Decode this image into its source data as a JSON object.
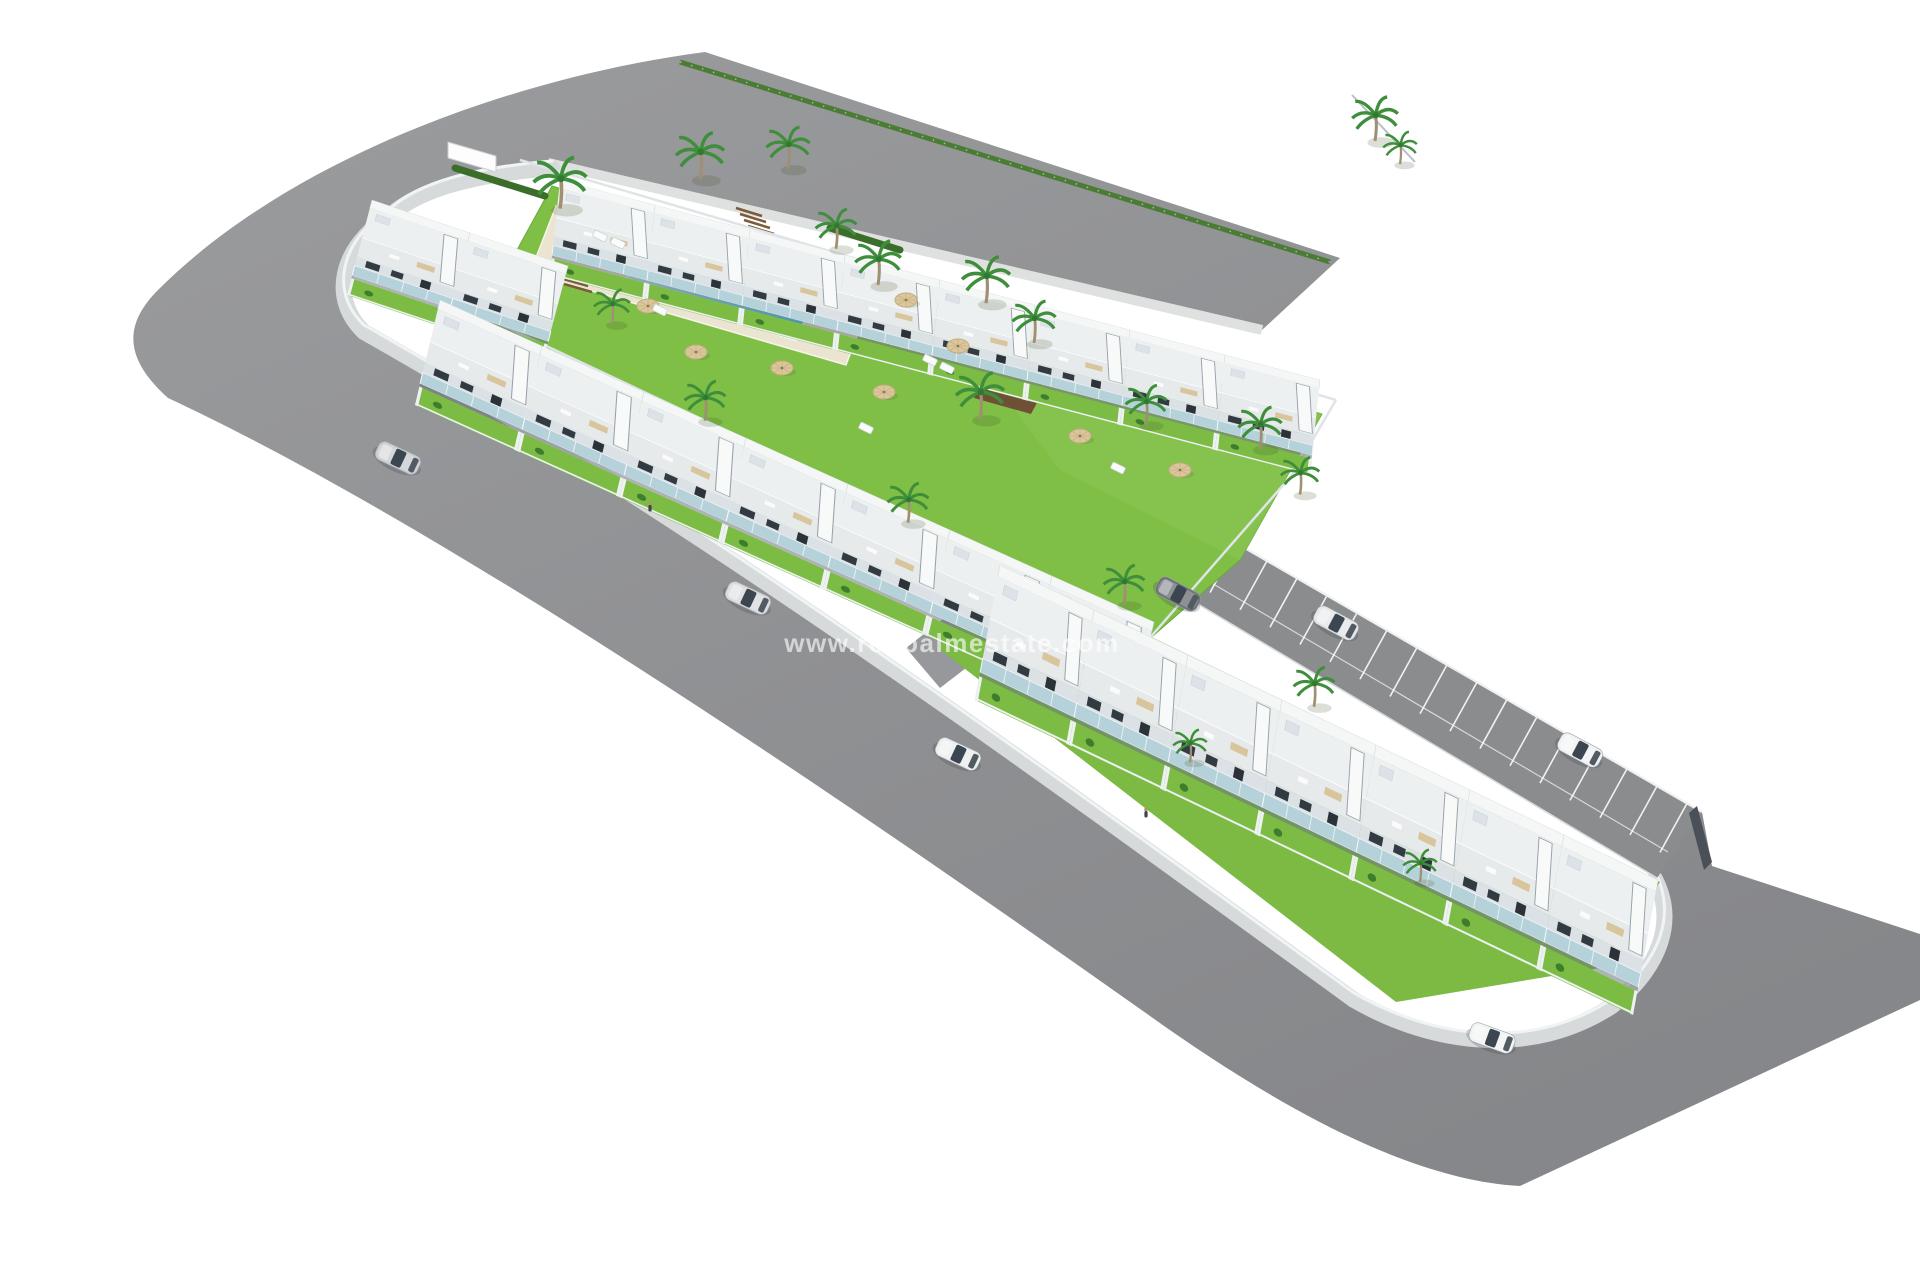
{
  "meta": {
    "kind": "3d-aerial-architectural-render",
    "subject": "residential development with townhouse rows, central pool garden, parking strip and L-shaped perimeter roads"
  },
  "watermark": {
    "text": "www.redpalmestate.com",
    "x": 952,
    "y": 652,
    "font_size": 26,
    "letter_spacing": 1.5,
    "color": "#ffffff",
    "opacity": 0.62
  },
  "palette": {
    "background": "#ffffff",
    "road_light": "#9b9c9e",
    "road_dark": "#86878a",
    "parking_asphalt": "#8a8c8e",
    "sidewalk": "#d7dadb",
    "curb_white": "#f1f4f5",
    "lawn": "#7fbf46",
    "lawn_light": "#8ac653",
    "hedge": "#4b7c33",
    "pool_deep": "#2eb6e2",
    "pool_light": "#bfeef8",
    "kids_pool": "#6fd4ef",
    "deck": "#eae4d1",
    "house_white": "#f5f7f6",
    "roof": "#edf0f0",
    "terrace": "#e6eaeb",
    "facade_shade": "#dbe1e5",
    "window_dark": "#323a42",
    "balcony_glass": "#b5d1d9",
    "wall_gray": "#dfe4e8",
    "steps_brown": "#7b5b3b",
    "pergola_brown": "#6f5036",
    "parasol_tan": "#dbc79d",
    "car_glass": "#3c4651",
    "dark_wall": "#4a5058"
  },
  "road": {
    "outline": "M1340,258 L705,52 C520,76 292,156 158,290 C120,328 128,362 168,398 C430,520 810,775 1150,1016 C1275,1105 1408,1180 1520,1186 L1920,1000 L1920,934 L1712,866 L1702,812 L1042,431 L1005,489 L1657,878 C1678,922 1662,968 1610,1008 C1530,1062 1430,1048 1352,1000 C1052,780 700,522 364,332 C330,300 338,248 392,214 C420,190 470,175 552,168 L1262,330 Z",
    "sidewalk": "M552,168 C470,175 420,190 392,214 C338,248 330,300 364,332 C700,522 1052,780 1354,1000 C1434,1046 1532,1058 1612,1006 C1662,966 1676,920 1655,879",
    "verge": [
      548,
      163,
      1262,
      330
    ],
    "hedge": [
      680,
      62,
      1330,
      262
    ],
    "fence_ne": [
      1352,
      95,
      1415,
      162
    ]
  },
  "parking": {
    "surface": [
      [
        1042,
        431
      ],
      [
        1702,
        812
      ],
      [
        1657,
        878
      ],
      [
        1005,
        489
      ]
    ],
    "ne_edge": [
      1042,
      431,
      1702,
      812
    ],
    "sw_edge": [
      1005,
      489,
      1657,
      878
    ],
    "lane_line": [
      1020,
      470,
      1668,
      852
    ],
    "bays": 22,
    "bay_vector": [
      -27,
      49
    ],
    "line_color": "#f0f1f2",
    "end_wall": [
      [
        1697,
        806
      ],
      [
        1712,
        862
      ],
      [
        1704,
        870
      ],
      [
        1689,
        813
      ]
    ],
    "driveway": [
      [
        906,
        648
      ],
      [
        952,
        612
      ],
      [
        992,
        648
      ],
      [
        940,
        688
      ]
    ]
  },
  "lawns": {
    "main": [
      [
        552,
        186
      ],
      [
        1322,
        414
      ],
      [
        1240,
        560
      ],
      [
        1146,
        642
      ],
      [
        470,
        336
      ]
    ],
    "light_overlay": [
      [
        940,
        310
      ],
      [
        1322,
        414
      ],
      [
        1240,
        560
      ],
      [
        1060,
        470
      ]
    ],
    "row_c_base": [
      [
        1002,
        565
      ],
      [
        1660,
        882
      ],
      [
        1600,
        968
      ],
      [
        1396,
        1002
      ],
      [
        938,
        648
      ]
    ]
  },
  "pool": {
    "deck": [
      [
        556,
        206
      ],
      [
        872,
        297
      ],
      [
        846,
        365
      ],
      [
        530,
        273
      ]
    ],
    "water": [
      [
        640,
        250
      ],
      [
        814,
        300
      ],
      [
        796,
        340
      ],
      [
        622,
        288
      ]
    ],
    "kids": [
      [
        585,
        222
      ],
      [
        634,
        236
      ],
      [
        626,
        252
      ],
      [
        577,
        238
      ]
    ],
    "steps": [
      [
        736,
        208,
        762,
        216
      ],
      [
        740,
        214,
        766,
        222
      ],
      [
        744,
        220,
        770,
        228
      ],
      [
        748,
        226,
        774,
        234
      ],
      [
        556,
        272,
        584,
        280
      ],
      [
        560,
        278,
        588,
        286
      ],
      [
        564,
        284,
        592,
        292
      ]
    ],
    "pergola": [
      [
        983,
        381
      ],
      [
        1040,
        397
      ],
      [
        1031,
        414
      ],
      [
        974,
        398
      ]
    ]
  },
  "rows": [
    {
      "name": "top-row",
      "origin": [
        560,
        180
      ],
      "spacing": [
        95,
        25
      ],
      "depth": [
        -10,
        95
      ],
      "count": 8
    },
    {
      "name": "west-corner-row",
      "origin": [
        372,
        200
      ],
      "spacing": [
        98,
        33
      ],
      "depth": [
        -25,
        95
      ],
      "count": 2
    },
    {
      "name": "south-row-upper-block",
      "origin": [
        440,
        300
      ],
      "spacing": [
        102,
        46
      ],
      "depth": [
        -25,
        105
      ],
      "count": 7
    },
    {
      "name": "lower-row",
      "origin": [
        1000,
        565
      ],
      "spacing": [
        94,
        45
      ],
      "depth": [
        -25,
        135
      ],
      "count": 7
    }
  ],
  "walls": [
    [
      520,
      160,
      1336,
      400
    ],
    [
      1336,
      400,
      1292,
      475
    ],
    [
      1292,
      475,
      1148,
      640
    ],
    [
      440,
      296,
      1146,
      628
    ]
  ],
  "palms": [
    [
      560,
      205,
      1.1
    ],
    [
      700,
      176,
      1
    ],
    [
      788,
      166,
      0.9
    ],
    [
      836,
      246,
      0.85
    ],
    [
      878,
      282,
      0.95
    ],
    [
      986,
      300,
      1
    ],
    [
      1034,
      340,
      0.9
    ],
    [
      980,
      416,
      1
    ],
    [
      1146,
      422,
      0.85
    ],
    [
      1260,
      446,
      0.9
    ],
    [
      1300,
      492,
      0.8
    ],
    [
      705,
      418,
      0.85
    ],
    [
      908,
      520,
      0.85
    ],
    [
      1124,
      602,
      0.85
    ],
    [
      1314,
      704,
      0.85
    ],
    [
      612,
      322,
      0.75
    ],
    [
      1375,
      138,
      0.95
    ],
    [
      1400,
      162,
      0.7
    ],
    [
      1190,
      760,
      0.7
    ],
    [
      1420,
      880,
      0.7
    ]
  ],
  "parasols": [
    [
      648,
      306
    ],
    [
      696,
      352
    ],
    [
      782,
      368
    ],
    [
      884,
      392
    ],
    [
      958,
      346
    ],
    [
      906,
      300
    ],
    [
      1080,
      436
    ],
    [
      1180,
      470
    ]
  ],
  "loungers": [
    [
      600,
      236
    ],
    [
      618,
      243
    ],
    [
      930,
      360
    ],
    [
      947,
      368
    ],
    [
      866,
      428
    ],
    [
      1118,
      468
    ],
    [
      660,
      310
    ]
  ],
  "hedgerows": [
    [
      455,
      168,
      545,
      196
    ],
    [
      830,
      228,
      900,
      250
    ]
  ],
  "utility_box": [
    [
      448,
      142
    ],
    [
      496,
      156
    ],
    [
      496,
      172
    ],
    [
      448,
      158
    ]
  ],
  "figures": [
    [
      650,
      508
    ],
    [
      1146,
      814
    ]
  ],
  "cars": [
    {
      "x": 398,
      "y": 458,
      "angle": 25,
      "color": "#c9cdd1",
      "state": "driving"
    },
    {
      "x": 748,
      "y": 598,
      "angle": 25,
      "color": "#d8dadc",
      "state": "driving"
    },
    {
      "x": 958,
      "y": 754,
      "angle": 25,
      "color": "#ebedee",
      "state": "driving"
    },
    {
      "x": 1336,
      "y": 623,
      "angle": 28,
      "color": "#e4e6e8",
      "state": "driving"
    },
    {
      "x": 1178,
      "y": 594,
      "angle": 28,
      "color": "#6d7277",
      "state": "parked"
    },
    {
      "x": 1580,
      "y": 750,
      "angle": 28,
      "color": "#f0f1f2",
      "state": "parked"
    },
    {
      "x": 1492,
      "y": 1038,
      "angle": 20,
      "color": "#f1f2f3",
      "state": "driving"
    }
  ]
}
